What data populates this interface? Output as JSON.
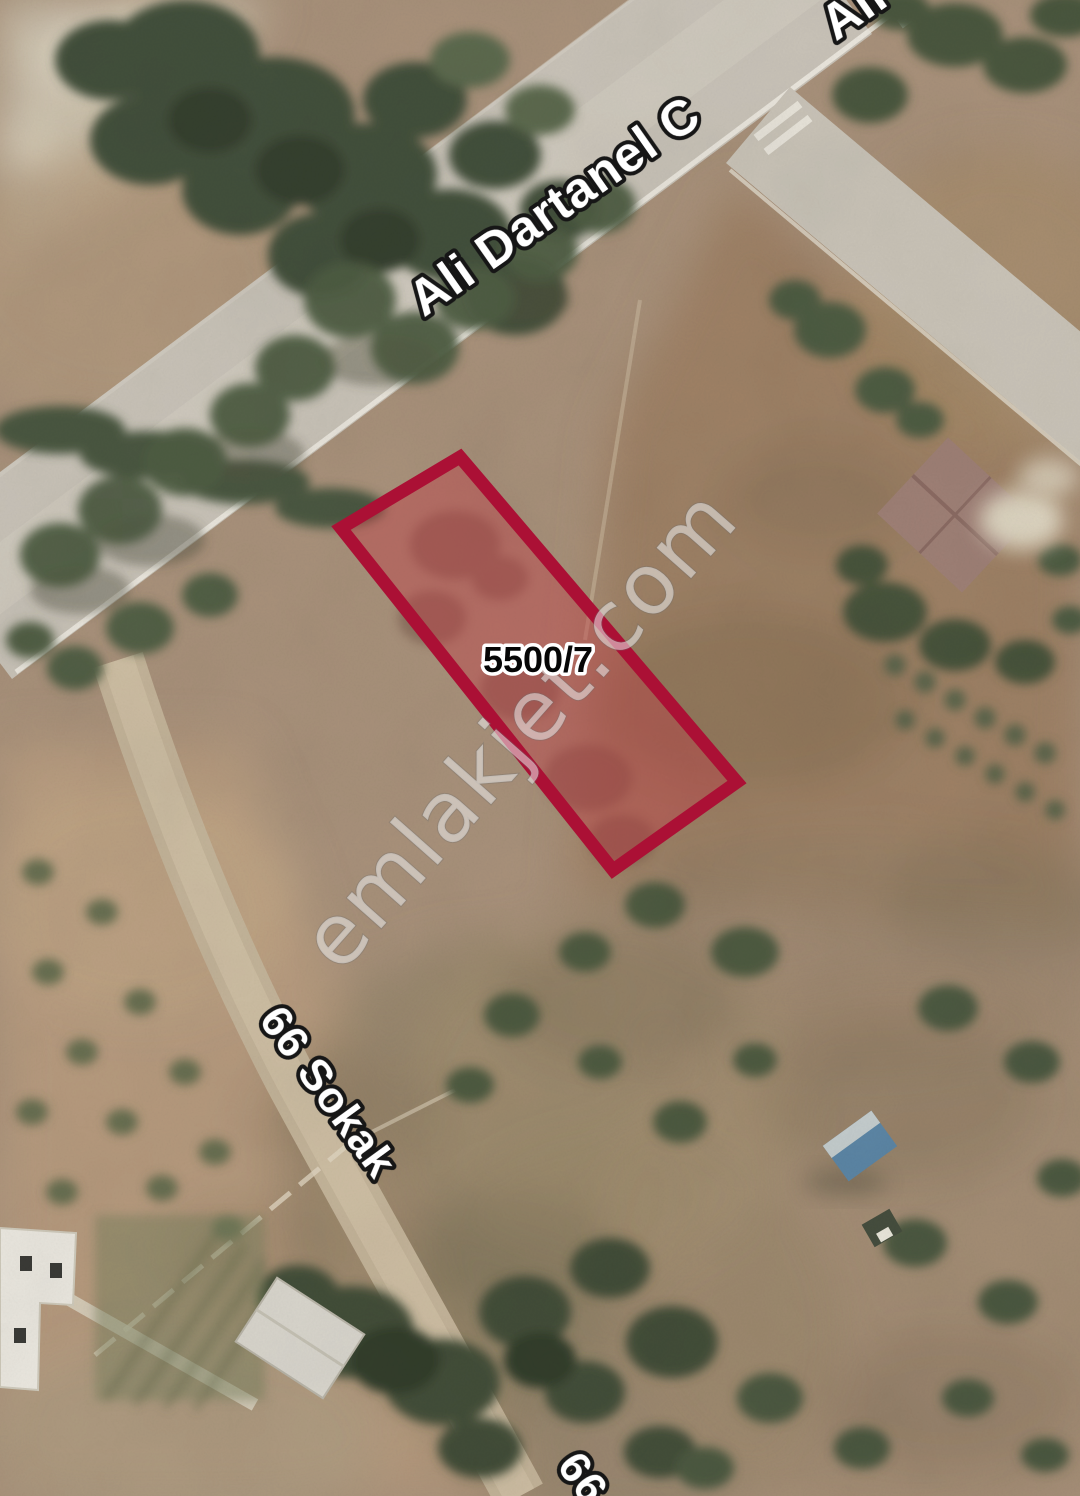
{
  "map": {
    "parcel": {
      "number": "5500/7",
      "outline_color": "#ab1035",
      "fill_color": "#c23b46"
    },
    "street_labels": {
      "ali_dartanel": "Ali Dartanel C",
      "ali_dartanel_partial": "Ali",
      "sokak_66": "66 Sokak",
      "sokak_66_partial": "66 S"
    },
    "watermark": {
      "text": "emlakjet.com",
      "color": "#ececec"
    }
  }
}
